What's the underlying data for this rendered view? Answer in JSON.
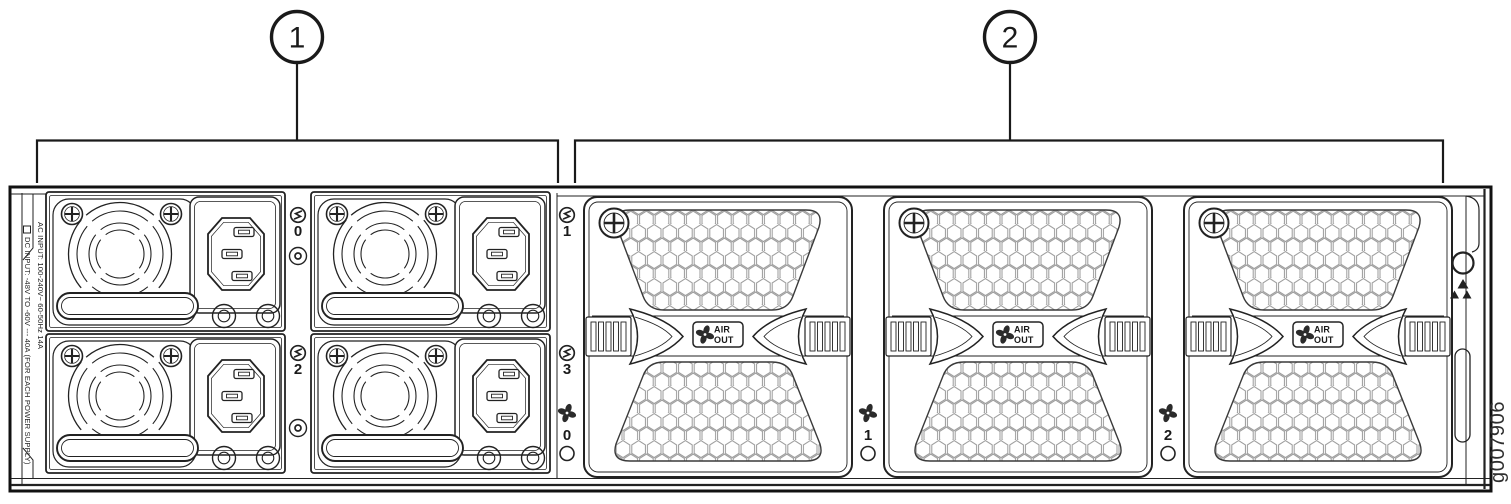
{
  "callouts": [
    {
      "label": "1"
    },
    {
      "label": "2"
    }
  ],
  "chassis": {
    "ac_input": "AC INPUT: 100-240V~ 60-50Hz 14A",
    "dc_input": "DC INPUT: -48V TO -60V --- 40A   (FOR EACH POWER SUPPLY)"
  },
  "psu": {
    "slots": [
      "0",
      "1",
      "2",
      "3"
    ]
  },
  "fans": {
    "slots": [
      "0",
      "1",
      "2"
    ],
    "badge": {
      "line1": "AIR",
      "line2": "OUT"
    }
  },
  "figure_id": "g007906",
  "icons": {
    "psu_slot": "power-icon (circle with bolt)",
    "fan_slot": "fan-icon (4-blade pinwheel)",
    "psu_led": "ring-led",
    "fan_led": "round-led",
    "screw": "phillips-screw-icon",
    "esd": "esd-ground-icon"
  },
  "colors": {
    "line": "#1a1a1a",
    "honeycomb": "#9a9a9a",
    "background": "#ffffff"
  }
}
